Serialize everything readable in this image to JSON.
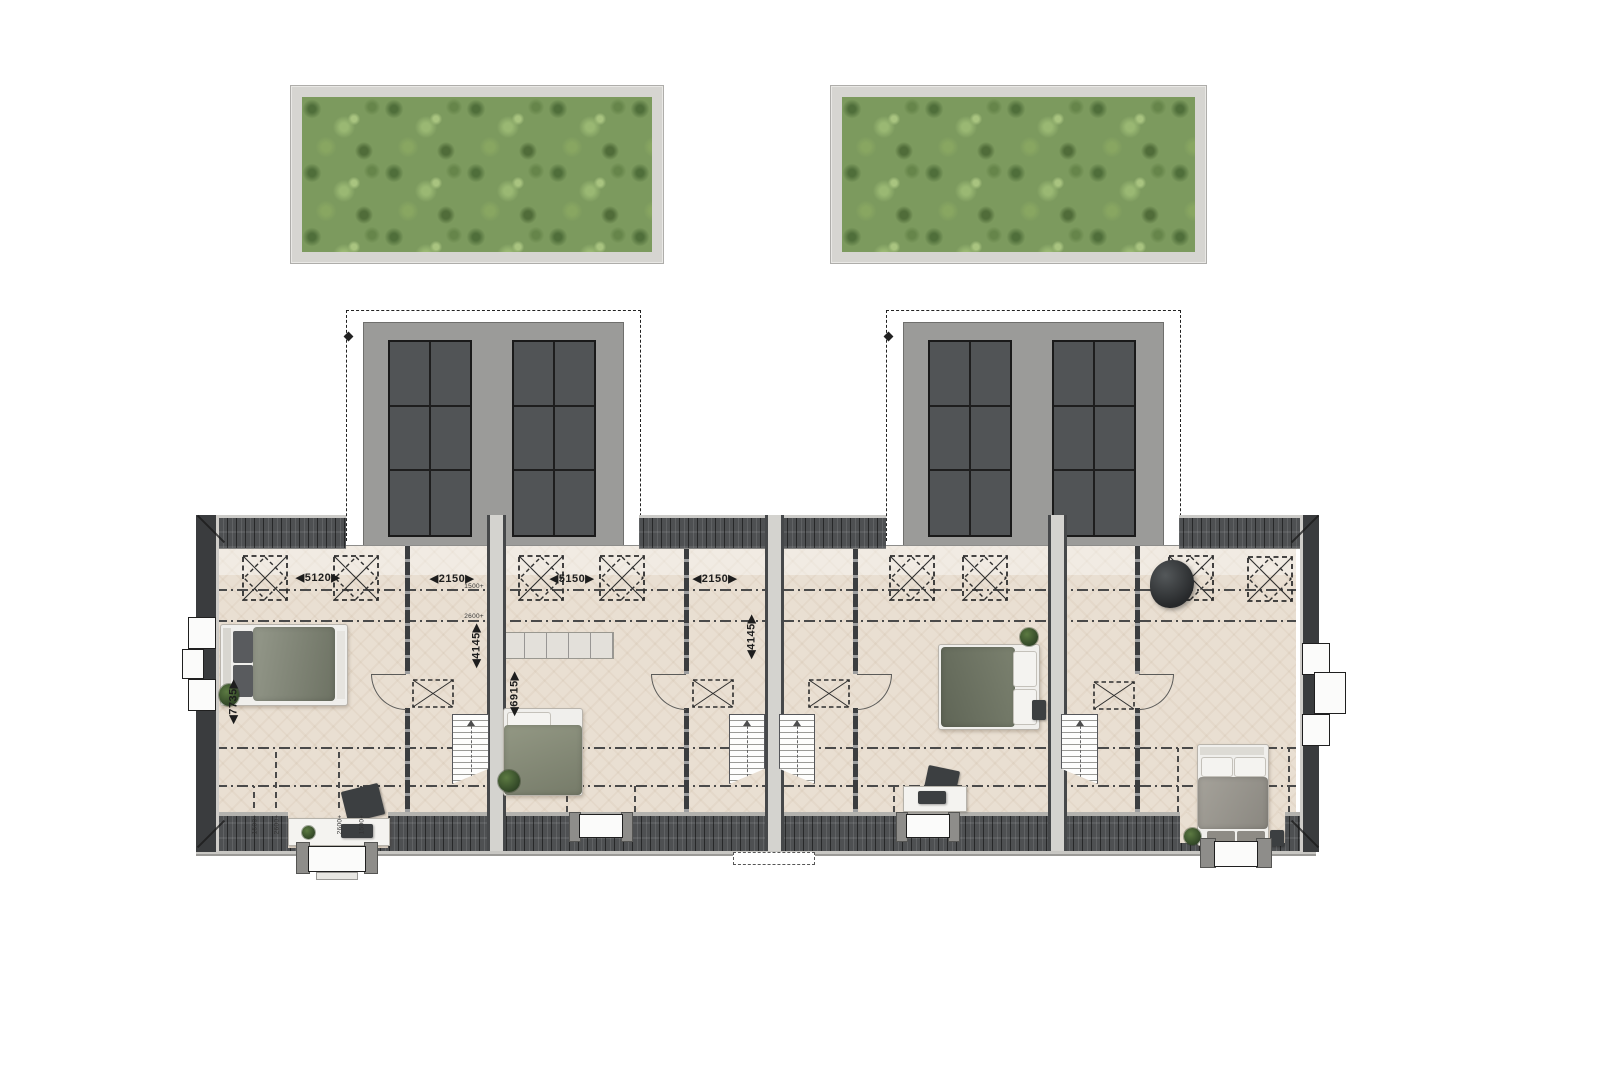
{
  "dimensions": {
    "room1_width": "◀5120▶",
    "hall1_width": "◀2150▶",
    "room2_width": "◀5150▶",
    "hall2_width": "◀2150▶",
    "room1_depth": "◀7735▶",
    "hall1_depth": "◀4145▶",
    "room2_depth": "◀6915▶",
    "hall2_depth": "◀4145▶"
  },
  "height_marks": {
    "top_1500": "1500+",
    "top_2600": "2600+",
    "bottom": [
      "1500+",
      "2600+",
      "2600+",
      "1500+"
    ]
  },
  "colors": {
    "floor": "#e9dfd2",
    "roof-tile": "#4e5052",
    "wall-dark": "#3a3c3e",
    "party-fill": "#d4d3cf",
    "dormer-body": "#9b9b99",
    "dormer-panel": "#515456",
    "green-base": "#7c9a5e",
    "green-dark": "#4f6e3a",
    "green-light": "#9ab873",
    "frame-gray": "#d6d5d1",
    "duvet-green": "#8b9180",
    "duvet-dark": "#6e7465",
    "duvet-gray": "#9a978f"
  }
}
